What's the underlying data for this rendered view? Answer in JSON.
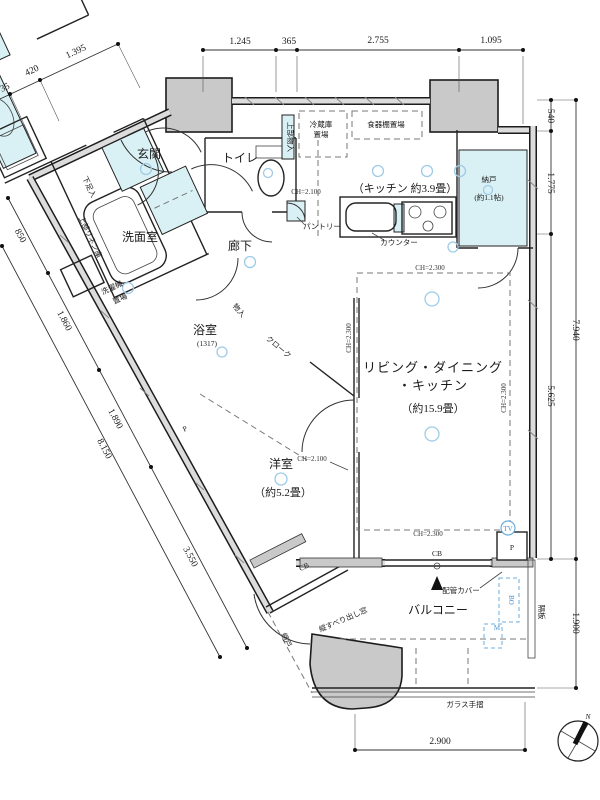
{
  "plan": {
    "rooms": {
      "genkan": "玄関",
      "toilet": "トイレ",
      "washroom": "洗面室",
      "hallway": "廊下",
      "kitchen": "（キッチン 約3.9畳）",
      "nando_name": "納戸",
      "nando_size": "(約1.1帖)",
      "ld_line1": "リビング・ダイニング",
      "ld_line2": "・キッチン",
      "ld_size": "（約15.9畳）",
      "bath_name": "浴室",
      "bath_size": "(1317)",
      "bedroom_name": "洋室",
      "bedroom_size": "（約5.2畳）",
      "balcony": "バルコニー"
    },
    "features": {
      "shoe_box": "下足入",
      "linen": "上部リネン庫",
      "washer_line1": "洗濯機",
      "washer_line2": "置場",
      "storage": "物入",
      "cloak": "クローク",
      "upper_storage": "上部物入",
      "fridge_line1": "冷蔵庫",
      "fridge_line2": "置場",
      "cupboard": "食器棚置場",
      "pantry": "パントリー",
      "counter": "カウンター",
      "pipe_cover": "配管カバー",
      "casement_window": "縦すべり出し窓",
      "screen_door": "網戸",
      "partition_panel": "隔板",
      "glass_rail": "ガラス手摺",
      "p_mark": "P",
      "cb_mark": "CB",
      "m_mark": "M",
      "bo_mark": "BO",
      "tv_mark": "TV",
      "north_mark": "N"
    },
    "ceiling": {
      "ch2100": "CH=2.100",
      "ch2300": "CH=2.300"
    },
    "dimensions": {
      "top": [
        "1.245",
        "365",
        "2.755",
        "1.095"
      ],
      "top_left": [
        "35",
        "420",
        "1.395"
      ],
      "right": [
        "540",
        "1.775",
        "5.625",
        "7.940",
        "1.900"
      ],
      "left": [
        "850",
        "1.860",
        "1.890",
        "8.150",
        "3.550"
      ],
      "bottom": [
        "2.900"
      ]
    }
  }
}
